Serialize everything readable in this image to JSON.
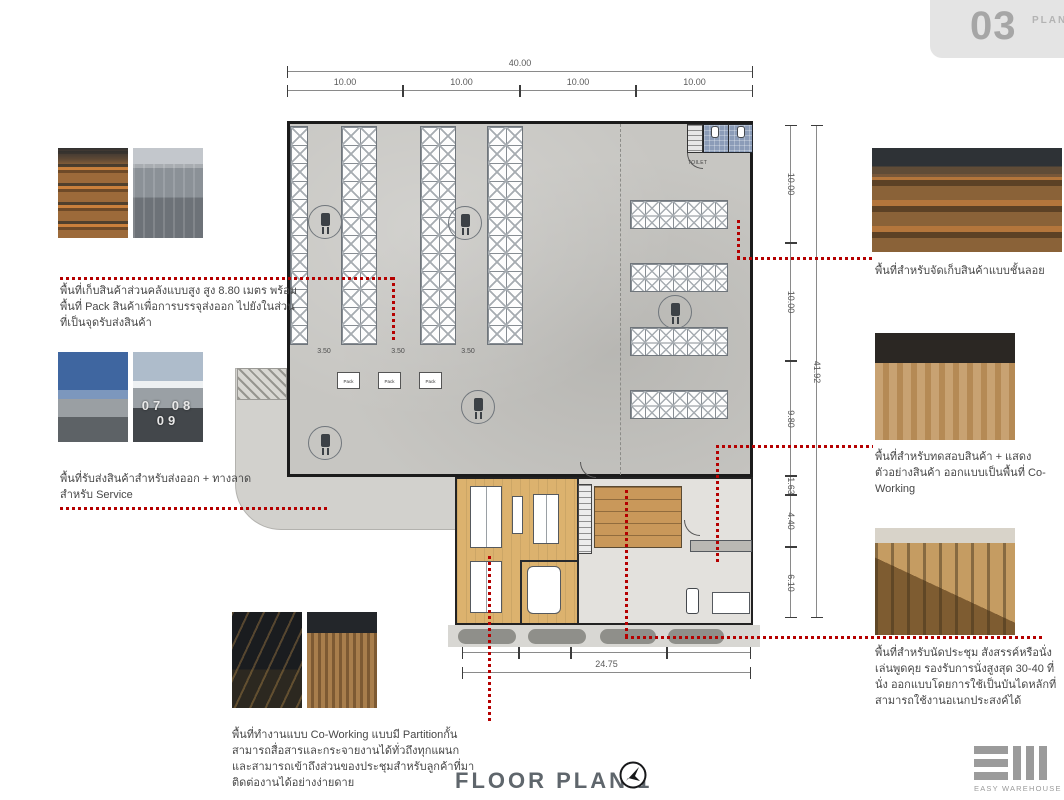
{
  "badge": {
    "number": "03",
    "label": "PLAN"
  },
  "title": {
    "text": "FLOOR PLAN 1"
  },
  "logo": {
    "name": "EASY WAREHOUSE"
  },
  "dimensions": {
    "top": {
      "total": "40.00",
      "segments": [
        "10.00",
        "10.00",
        "10.00",
        "10.00"
      ]
    },
    "right": {
      "total": "41.92",
      "segments": [
        "10.00",
        "10.00",
        "9.80",
        "1.63",
        "4.40",
        "6.10"
      ]
    },
    "bottom": {
      "total": "24.75",
      "segments": [
        "4.925",
        "4.425",
        "8.20",
        "7.20"
      ]
    },
    "aisles": [
      "3.50",
      "3.50",
      "3.50"
    ]
  },
  "plan": {
    "pack_label": "Pack",
    "toilet_label": "TOILET"
  },
  "annotations": {
    "storage": "พื้นที่เก็บสินค้าส่วนคลังแบบสูง สูง 8.80 เมตร พร้อมพื้นที่ Pack สินค้าเพื่อการบรรจุส่งออก ไปยังในส่วนที่เป็นจุดรับส่งสินค้า",
    "loading": "พื้นที่รับส่งสินค้าสำหรับส่งออก + ทางลาดสำหรับ Service",
    "coworking": "พื้นที่ทำงานแบบ Co-Working แบบมี Partitionกั้น สามารถสื่อสารและกระจายงานได้ทั่วถึงทุกแผนกและสามารถเข้าถึงส่วนของประชุมสำหรับลูกค้าที่มาติดต่องานได้อย่างง่ายดาย",
    "mezzanine": "พื้นที่สำหรับจัดเก็บสินค้าแบบชั้นลอย",
    "showroom": "พื้นที่สำหรับทดสอบสินค้า + แสดงตัวอย่างสินค้า ออกแบบเป็นพื้นที่ Co-Working",
    "meeting_steps": "พื้นที่สำหรับนัดประชุม สังสรรค์หรือนั่งเล่นพูดคุย รองรับการนั่งสูงสุด 30-40 ที่นั่ง ออกแบบโดยการใช้เป็นบันไดหลักที่สามารถใช้งานอเนกประสงค์ได้"
  },
  "photos": {
    "dock_numbers": "07  08  09"
  },
  "colors": {
    "accent_red": "#b50000",
    "floor_gray": "#c7c6c2",
    "wood": "#dcb26e",
    "badge_gray": "#e4e4e4"
  }
}
